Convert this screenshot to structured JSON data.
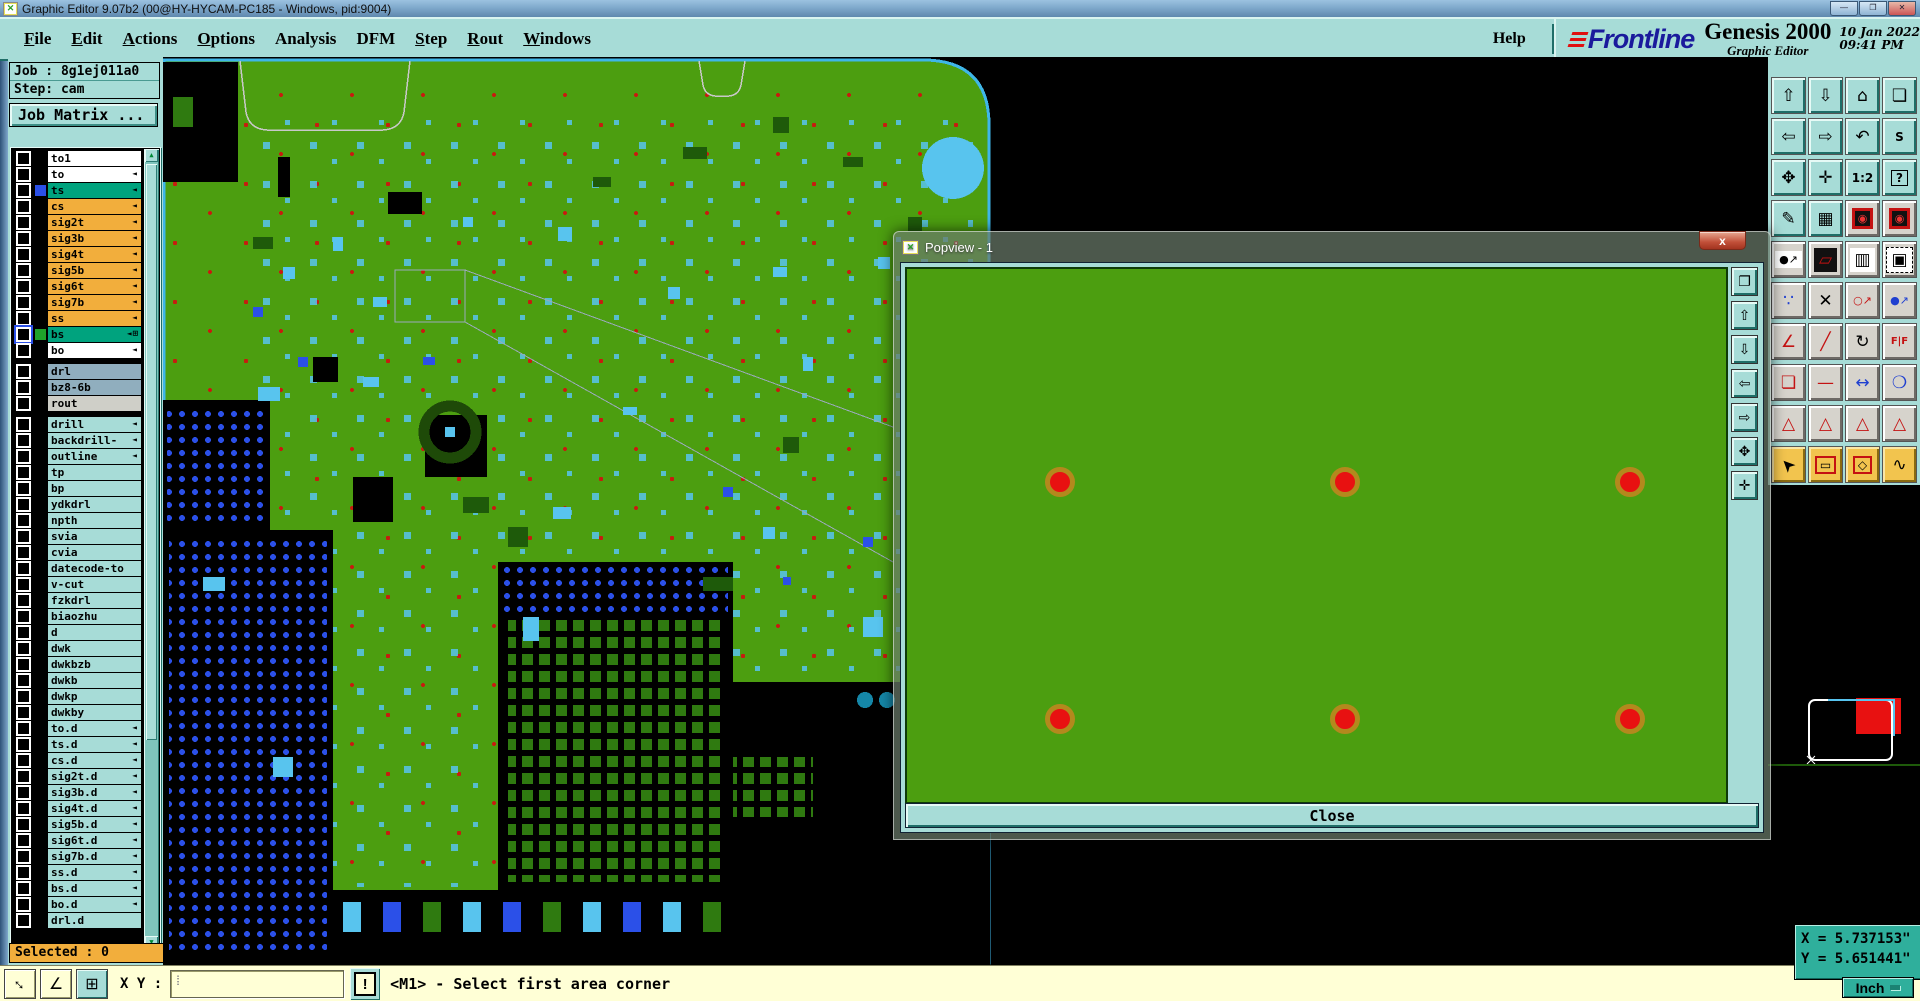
{
  "window": {
    "title": "Graphic Editor 9.07b2 (00@HY-HYCAM-PC185 - Windows, pid:9004)",
    "controls": [
      {
        "name": "minimize-button",
        "glyph": "—"
      },
      {
        "name": "maximize-button",
        "glyph": "❐"
      },
      {
        "name": "close-button",
        "glyph": "✕",
        "cls": "close-button"
      }
    ]
  },
  "menu": {
    "items": [
      {
        "label": "File",
        "u": 0
      },
      {
        "label": "Edit",
        "u": 0
      },
      {
        "label": "Actions",
        "u": 0
      },
      {
        "label": "Options",
        "u": 0
      },
      {
        "label": "Analysis"
      },
      {
        "label": "DFM"
      },
      {
        "label": "Step",
        "u": 0
      },
      {
        "label": "Rout",
        "u": 0
      },
      {
        "label": "Windows",
        "u": 0
      }
    ],
    "help": "Help"
  },
  "brand": {
    "logo": "Frontline",
    "product": "Genesis 2000",
    "subtitle": "Graphic Editor",
    "date": "10 Jan 2022",
    "time": "09:41 PM"
  },
  "job": {
    "job_label": "Job : 8g1ej011a0",
    "step_label": "Step: cam",
    "matrix_button": "Job Matrix ..."
  },
  "layers": [
    {
      "label": "to1",
      "cls": "white"
    },
    {
      "label": "to",
      "cls": "white",
      "arrow": 1
    },
    {
      "label": "ts",
      "cls": "green",
      "arrow": 1,
      "swatch": "#2B50E8"
    },
    {
      "label": "cs",
      "cls": "orange",
      "arrow": 1
    },
    {
      "label": "sig2t",
      "cls": "orange",
      "arrow": 1
    },
    {
      "label": "sig3b",
      "cls": "orange",
      "arrow": 1
    },
    {
      "label": "sig4t",
      "cls": "orange",
      "arrow": 1
    },
    {
      "label": "sig5b",
      "cls": "orange",
      "arrow": 1
    },
    {
      "label": "sig6t",
      "cls": "orange",
      "arrow": 1
    },
    {
      "label": "sig7b",
      "cls": "orange",
      "arrow": 1
    },
    {
      "label": "ss",
      "cls": "orange",
      "arrow": 1
    },
    {
      "label": "bs",
      "cls": "green cbsel",
      "arrow": 1,
      "swatch": "#1FA32A",
      "extra": "⊞"
    },
    {
      "label": "bo",
      "cls": "white",
      "arrow": 1
    },
    {
      "cls": "sep"
    },
    {
      "label": "drl",
      "cls": "grayblue"
    },
    {
      "label": "bz8-6b",
      "cls": "grayblue"
    },
    {
      "label": "rout",
      "cls": "lightgray"
    },
    {
      "cls": "sep"
    },
    {
      "label": "drill",
      "cls": "teal",
      "arrow": 1
    },
    {
      "label": "backdrill-",
      "cls": "teal",
      "arrow": 1
    },
    {
      "label": "outline",
      "cls": "teal",
      "arrow": 1
    },
    {
      "label": "tp",
      "cls": "teal"
    },
    {
      "label": "bp",
      "cls": "teal"
    },
    {
      "label": "ydkdrl",
      "cls": "teal"
    },
    {
      "label": "npth",
      "cls": "teal"
    },
    {
      "label": "svia",
      "cls": "teal"
    },
    {
      "label": "cvia",
      "cls": "teal"
    },
    {
      "label": "datecode-to",
      "cls": "teal"
    },
    {
      "label": "v-cut",
      "cls": "teal"
    },
    {
      "label": "fzkdrl",
      "cls": "teal"
    },
    {
      "label": "biaozhu",
      "cls": "teal"
    },
    {
      "label": "d",
      "cls": "teal"
    },
    {
      "label": "dwk",
      "cls": "teal"
    },
    {
      "label": "dwkbzb",
      "cls": "teal"
    },
    {
      "label": "dwkb",
      "cls": "teal"
    },
    {
      "label": "dwkp",
      "cls": "teal"
    },
    {
      "label": "dwkby",
      "cls": "teal"
    },
    {
      "label": "to.d",
      "cls": "teal",
      "arrow": 1
    },
    {
      "label": "ts.d",
      "cls": "teal",
      "arrow": 1
    },
    {
      "label": "cs.d",
      "cls": "teal",
      "arrow": 1
    },
    {
      "label": "sig2t.d",
      "cls": "teal",
      "arrow": 1
    },
    {
      "label": "sig3b.d",
      "cls": "teal",
      "arrow": 1
    },
    {
      "label": "sig4t.d",
      "cls": "teal",
      "arrow": 1
    },
    {
      "label": "sig5b.d",
      "cls": "teal",
      "arrow": 1
    },
    {
      "label": "sig6t.d",
      "cls": "teal",
      "arrow": 1
    },
    {
      "label": "sig7b.d",
      "cls": "teal",
      "arrow": 1
    },
    {
      "label": "ss.d",
      "cls": "teal",
      "arrow": 1
    },
    {
      "label": "bs.d",
      "cls": "teal",
      "arrow": 1
    },
    {
      "label": "bo.d",
      "cls": "teal",
      "arrow": 1
    },
    {
      "label": "drl.d",
      "cls": "teal"
    }
  ],
  "selected_label": "Selected : 0",
  "toolbar": {
    "buttons": [
      {
        "name": "view-zoom-in-button",
        "glyph": "⇧",
        "cls": "teal"
      },
      {
        "name": "view-zoom-out-button",
        "glyph": "⇩",
        "cls": "teal"
      },
      {
        "name": "view-home-button",
        "glyph": "⌂",
        "cls": "teal"
      },
      {
        "name": "view-windows-xy-button",
        "glyph": "❏",
        "cls": "teal"
      },
      {
        "name": "view-pan-left-button",
        "glyph": "⇦",
        "cls": "teal"
      },
      {
        "name": "view-pan-right-button",
        "glyph": "⇨",
        "cls": "teal"
      },
      {
        "name": "view-previous-button",
        "glyph": "↶",
        "cls": "teal"
      },
      {
        "name": "serpentine-button",
        "glyph": "S",
        "cls": "teal fs12"
      },
      {
        "name": "zoom-fit-button",
        "glyph": "✥",
        "cls": "teal"
      },
      {
        "name": "zoom-center-button",
        "glyph": "✛",
        "cls": "teal"
      },
      {
        "name": "scale-1-2-button",
        "glyph": "1:2",
        "cls": "teal fs12"
      },
      {
        "name": "context-help-button",
        "glyph": "?",
        "cls": "teal boxed fs12"
      },
      {
        "name": "tools-setup-button",
        "glyph": "✎",
        "cls": "teal"
      },
      {
        "name": "grid-settings-button",
        "glyph": "▦",
        "cls": "teal"
      },
      {
        "name": "stoplight-1-button",
        "glyph": "◉",
        "cls": "gray traffic"
      },
      {
        "name": "stoplight-2-button",
        "glyph": "◉",
        "cls": "gray traffic"
      },
      {
        "name": "select-move-button",
        "glyph": "●↗",
        "cls": "gray grayw fs11"
      },
      {
        "name": "transform-button",
        "glyph": "▱",
        "cls": "gray dark c-red"
      },
      {
        "name": "ruler-button",
        "glyph": "▥",
        "cls": "gray grayw"
      },
      {
        "name": "select-pad-button",
        "glyph": "▣",
        "cls": "gray grayw dashed"
      },
      {
        "name": "net-points-button",
        "glyph": "∵",
        "cls": "gray c-blue"
      },
      {
        "name": "clear-selection-button",
        "glyph": "✕",
        "cls": "gray"
      },
      {
        "name": "copy-to-layer-button",
        "glyph": "○↗",
        "cls": "gray fs11 c-red"
      },
      {
        "name": "move-to-layer-button",
        "glyph": "●↗",
        "cls": "gray fs11 c-blue"
      },
      {
        "name": "measure-angle-button",
        "glyph": "∠",
        "cls": "gray c-red"
      },
      {
        "name": "measure-slope-button",
        "glyph": "╱",
        "cls": "gray c-red"
      },
      {
        "name": "rotate-button",
        "glyph": "↻",
        "cls": "gray"
      },
      {
        "name": "mirror-button",
        "glyph": "F|F",
        "cls": "gray fs10 c-red"
      },
      {
        "name": "copy-pad-button",
        "glyph": "❏",
        "cls": "gray c-red"
      },
      {
        "name": "break-segment-button",
        "glyph": "—",
        "cls": "gray c-red"
      },
      {
        "name": "measure-distance-button",
        "glyph": "↔",
        "cls": "gray c-blue"
      },
      {
        "name": "pad-stack-button",
        "glyph": "❍",
        "cls": "gray c-blue"
      },
      {
        "name": "dfm-marker-1-button",
        "glyph": "△",
        "cls": "gray c-red"
      },
      {
        "name": "dfm-marker-2-button",
        "glyph": "△",
        "cls": "gray c-red"
      },
      {
        "name": "dfm-marker-3-button",
        "glyph": "△",
        "cls": "gray c-red"
      },
      {
        "name": "dfm-marker-4-button",
        "glyph": "△",
        "cls": "gray c-red"
      },
      {
        "name": "mode-select-button",
        "glyph": "➤",
        "cls": "yellow rotUL"
      },
      {
        "name": "mode-select-rect-button",
        "glyph": "▭",
        "cls": "yellow framed fs12"
      },
      {
        "name": "mode-select-poly-button",
        "glyph": "◇",
        "cls": "yellow framed fs12"
      },
      {
        "name": "mode-select-net-button",
        "glyph": "∿",
        "cls": "yellow"
      }
    ]
  },
  "coords": {
    "x": "X = 5.737153\"",
    "y": "Y = 5.651441\"",
    "units": "Inch"
  },
  "statusbar": {
    "xy_label": "X Y :",
    "xy_value": "",
    "alert": "!",
    "message": "<M1> - Select first area corner"
  },
  "bottom_buttons": [
    {
      "name": "zoom-window-button",
      "glyph": "↔",
      "cls": "cream rot45"
    },
    {
      "name": "measure-angle-ok-button",
      "glyph": "∠",
      "cls": "cream"
    },
    {
      "name": "grid-window-button",
      "glyph": "⊞",
      "cls": "tealbtn"
    }
  ],
  "popview": {
    "title": "Popview - 1",
    "close_x": "x",
    "close_button": "Close",
    "dots": [
      {
        "x": 153,
        "y": 213
      },
      {
        "x": 438,
        "y": 213
      },
      {
        "x": 723,
        "y": 213
      },
      {
        "x": 153,
        "y": 450
      },
      {
        "x": 438,
        "y": 450
      },
      {
        "x": 723,
        "y": 450
      }
    ],
    "side_buttons": [
      {
        "name": "popview-clone-button",
        "glyph": "❐"
      },
      {
        "name": "popview-zoom-in-button",
        "glyph": "⇧"
      },
      {
        "name": "popview-zoom-out-button",
        "glyph": "⇩"
      },
      {
        "name": "popview-pan-left-button",
        "glyph": "⇦"
      },
      {
        "name": "popview-pan-right-button",
        "glyph": "⇨"
      },
      {
        "name": "popview-fit-button",
        "glyph": "✥"
      },
      {
        "name": "popview-center-button",
        "glyph": "✛"
      }
    ]
  }
}
